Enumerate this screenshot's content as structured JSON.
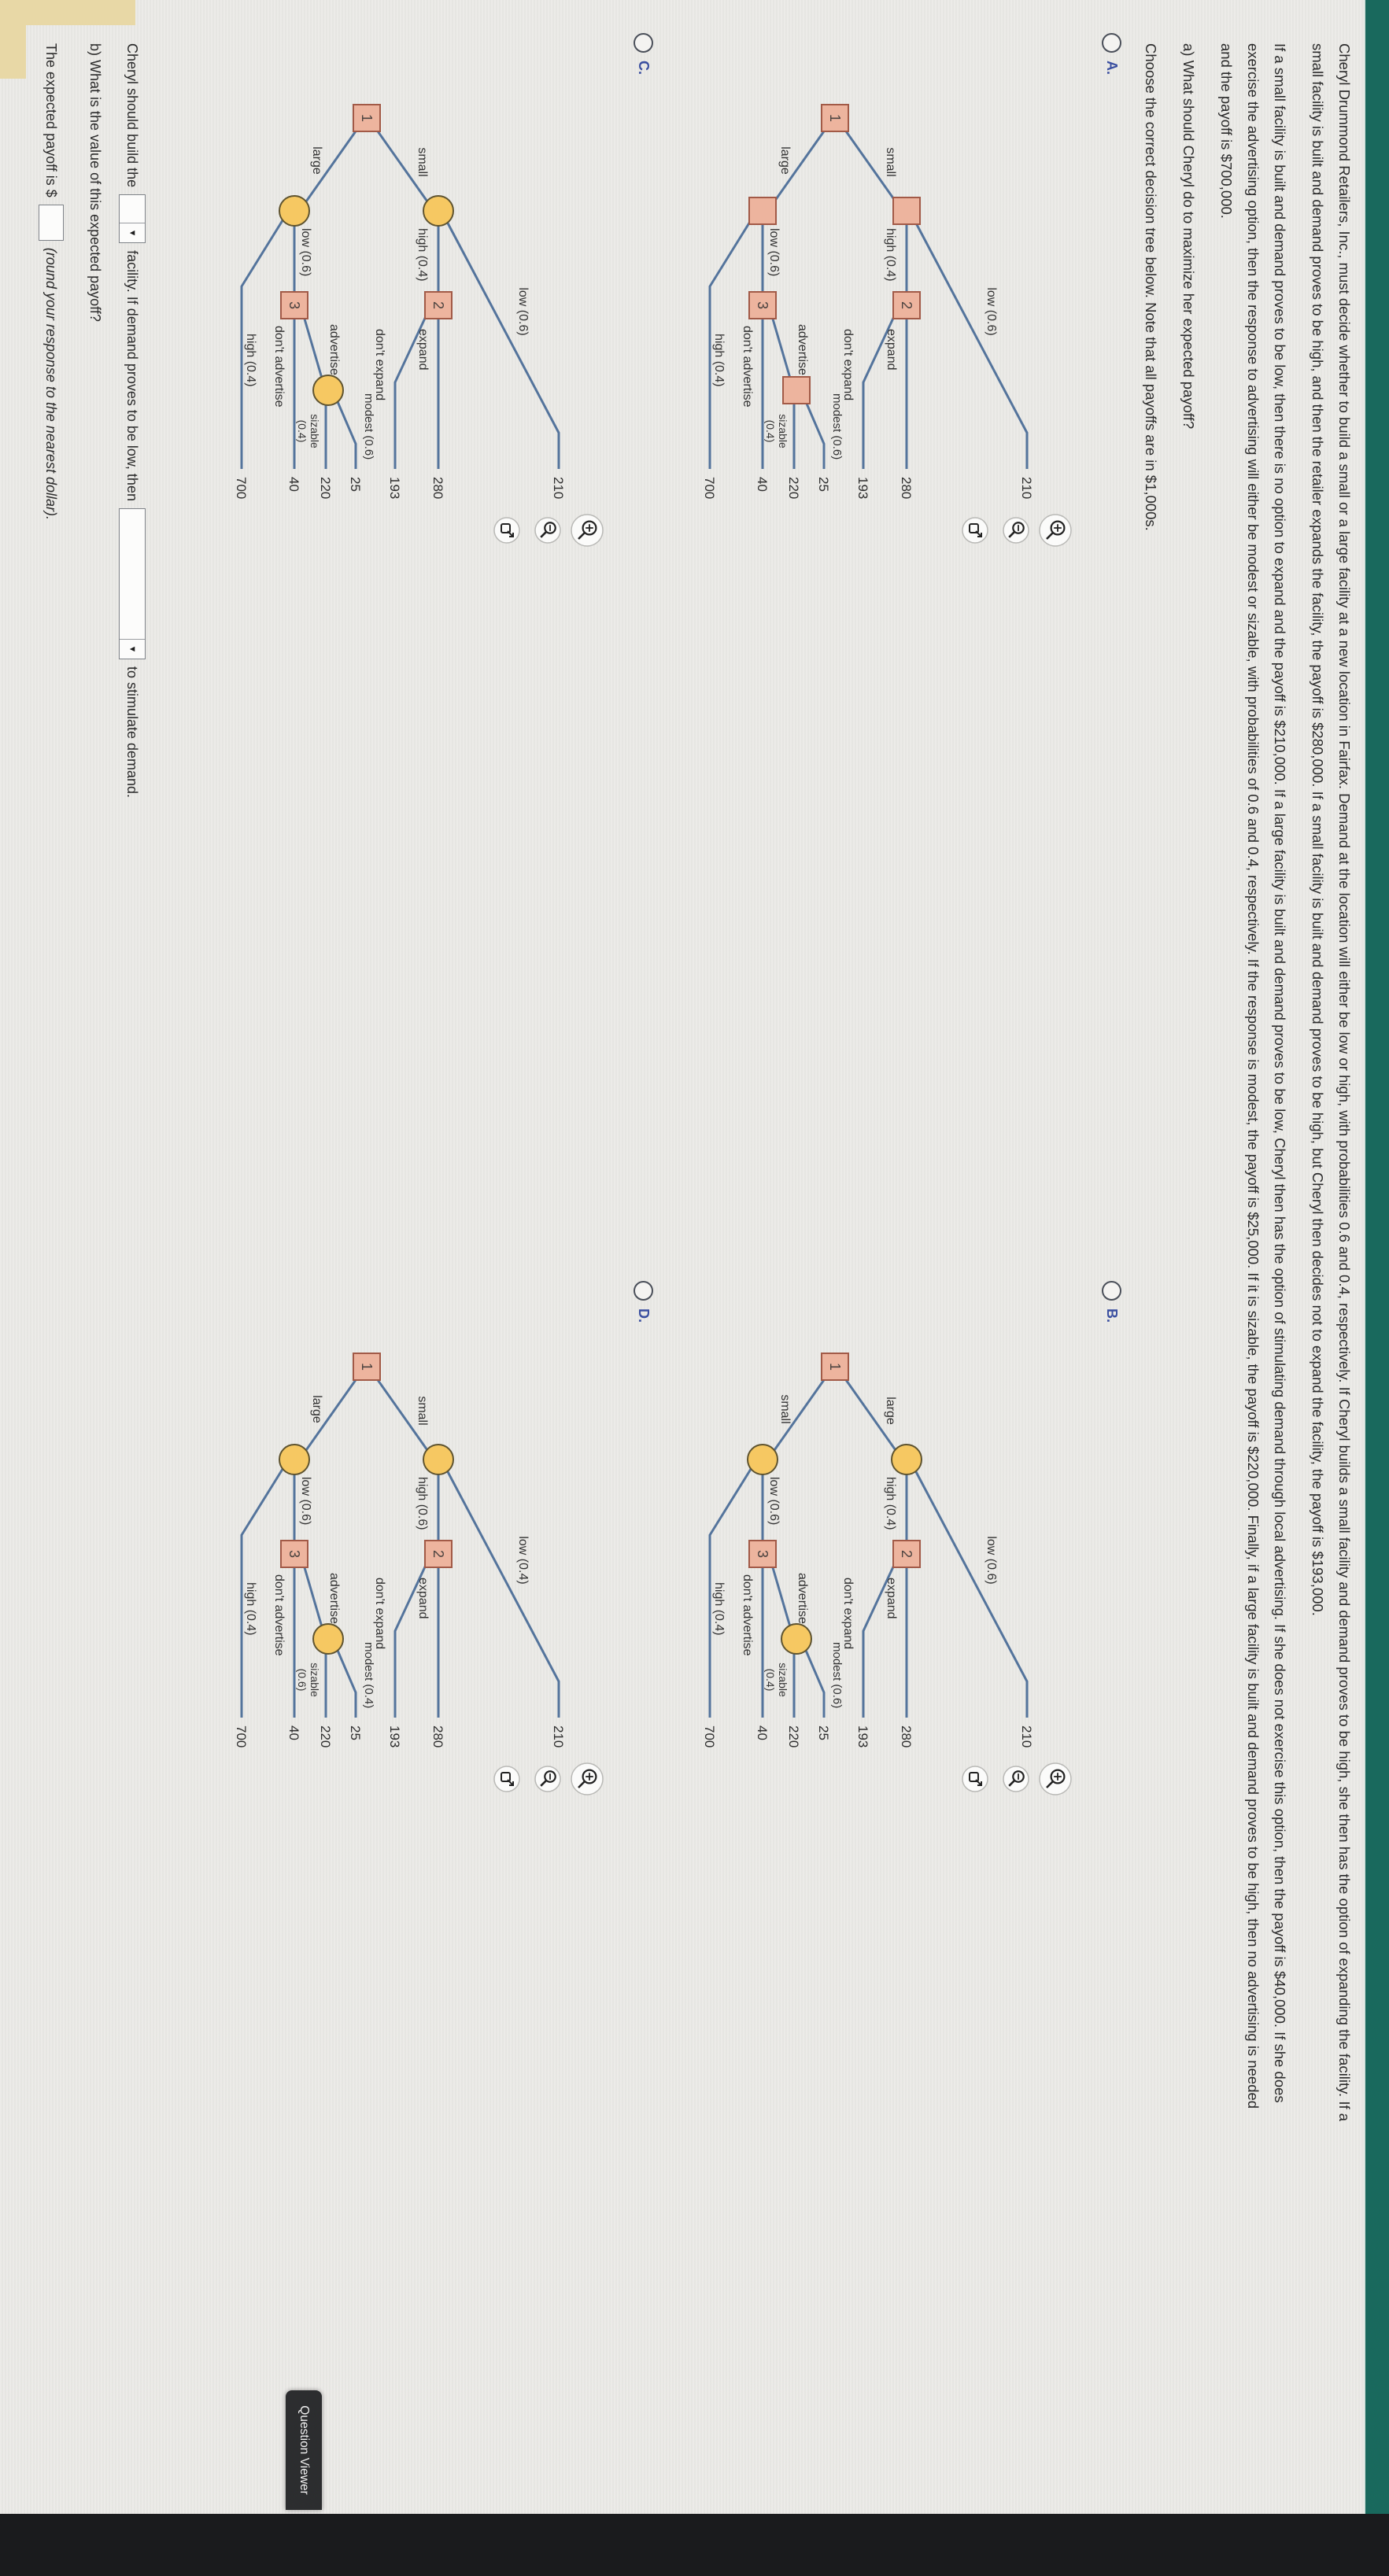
{
  "question": {
    "intro_lines": [
      "Cheryl Drummond Retailers, Inc., must decide whether to build a small or a large facility at a new location in Fairfax. Demand at the location will either be low or high, with probabilities 0.6 and 0.4, respectively. If Cheryl builds a small facility and demand proves to be high, she then has the option of expanding the facility. If a",
      "small facility is built and demand proves to be high, and then the retailer expands the facility, the payoff is $280,000. If a small facility is built and demand proves to be high, but Cheryl then decides not to expand the facility, the payoff is $193,000.",
      "If a small facility is built and demand proves to be low, then there is no option to expand and the payoff is $210,000. If a large facility is built and demand proves to be low, Cheryl then has the option of stimulating demand through local advertising. If she does not exercise this option, then the payoff is $40,000. If she does",
      "exercise the advertising option, then the response to advertising will either be modest or sizable, with probabilities of 0.6 and 0.4, respectively. If the response is modest, the payoff is $25,000. If it is sizable, the payoff is $220,000. Finally, if a large facility is built and demand proves to be high, then no advertising is needed",
      "and the payoff is $700,000."
    ],
    "part_a": "a) What should Cheryl do to maximize her expected payoff?",
    "choose_line": "Choose the correct decision tree below. Note that all payoffs are in $1,000s."
  },
  "options": [
    {
      "id": "A",
      "label": "A.",
      "tree": {
        "chance_shape": "square",
        "branch_top": "small",
        "branch_bottom": "large",
        "node1": "1",
        "node2": "2",
        "node3": "3",
        "top_low": "low (0.6)",
        "top_low_value": "210",
        "top_high": "high (0.4)",
        "expand": "expand",
        "expand_value": "280",
        "dont_expand": "don't expand",
        "dont_expand_value": "193",
        "bottom_low": "low (0.6)",
        "advertise": "advertise",
        "modest": "modest (0.6)",
        "modest_value": "25",
        "sizable_line1": "sizable",
        "sizable_line2": "(0.4)",
        "sizable_value": "220",
        "dont_advertise": "don't advertise",
        "dont_advertise_value": "40",
        "bottom_high": "high (0.4)",
        "bottom_high_value": "700"
      }
    },
    {
      "id": "B",
      "label": "B.",
      "tree": {
        "chance_shape": "circle",
        "branch_top": "large",
        "branch_bottom": "small",
        "node1": "1",
        "node2": "2",
        "node3": "3",
        "top_low": "low (0.6)",
        "top_low_value": "210",
        "top_high": "high (0.4)",
        "expand": "expand",
        "expand_value": "280",
        "dont_expand": "don't expand",
        "dont_expand_value": "193",
        "bottom_low": "low (0.6)",
        "advertise": "advertise",
        "modest": "modest (0.6)",
        "modest_value": "25",
        "sizable_line1": "sizable",
        "sizable_line2": "(0.4)",
        "sizable_value": "220",
        "dont_advertise": "don't advertise",
        "dont_advertise_value": "40",
        "bottom_high": "high (0.4)",
        "bottom_high_value": "700"
      }
    },
    {
      "id": "C",
      "label": "C.",
      "tree": {
        "chance_shape": "circle",
        "branch_top": "small",
        "branch_bottom": "large",
        "node1": "1",
        "node2": "2",
        "node3": "3",
        "top_low": "low (0.6)",
        "top_low_value": "210",
        "top_high": "high (0.4)",
        "expand": "expand",
        "expand_value": "280",
        "dont_expand": "don't expand",
        "dont_expand_value": "193",
        "bottom_low": "low (0.6)",
        "advertise": "advertise",
        "modest": "modest (0.6)",
        "modest_value": "25",
        "sizable_line1": "sizable",
        "sizable_line2": "(0.4)",
        "sizable_value": "220",
        "dont_advertise": "don't advertise",
        "dont_advertise_value": "40",
        "bottom_high": "high (0.4)",
        "bottom_high_value": "700"
      }
    },
    {
      "id": "D",
      "label": "D.",
      "tree": {
        "chance_shape": "circle",
        "branch_top": "small",
        "branch_bottom": "large",
        "node1": "1",
        "node2": "2",
        "node3": "3",
        "top_low": "low (0.4)",
        "top_low_value": "210",
        "top_high": "high (0.6)",
        "expand": "expand",
        "expand_value": "280",
        "dont_expand": "don't expand",
        "dont_expand_value": "193",
        "bottom_low": "low (0.6)",
        "advertise": "advertise",
        "modest": "modest (0.4)",
        "modest_value": "25",
        "sizable_line1": "sizable",
        "sizable_line2": "(0.6)",
        "sizable_value": "220",
        "dont_advertise": "don't advertise",
        "dont_advertise_value": "40",
        "bottom_high": "high (0.4)",
        "bottom_high_value": "700"
      }
    }
  ],
  "answer": {
    "build_1": "Cheryl should build the",
    "build_2": "facility. If demand proves to be low, then",
    "build_3": "to stimulate demand.",
    "part_b": "b) What is the value of this expected payoff?",
    "payoff_prefix": "The expected payoff is $",
    "payoff_suffix": "(round your response to the nearest dollar)."
  },
  "question_viewer": {
    "label": "Question Viewer"
  },
  "icons": [
    "zoom-in-icon",
    "zoom-out-icon",
    "open-graph-icon",
    "dropdown-caret-icon",
    "radio-icon"
  ],
  "colors": {
    "teal_bar": "#19695d",
    "page": "#ebeae7",
    "tree_line": "#54749c",
    "decision_node_fill": "#edb49e",
    "decision_node_stroke": "#a25a47",
    "chance_node_fill": "#f6c862",
    "chance_node_stroke": "#5f5430",
    "option_letter": "#3a4fa0",
    "viewer_tab": "#2c2d2f"
  }
}
